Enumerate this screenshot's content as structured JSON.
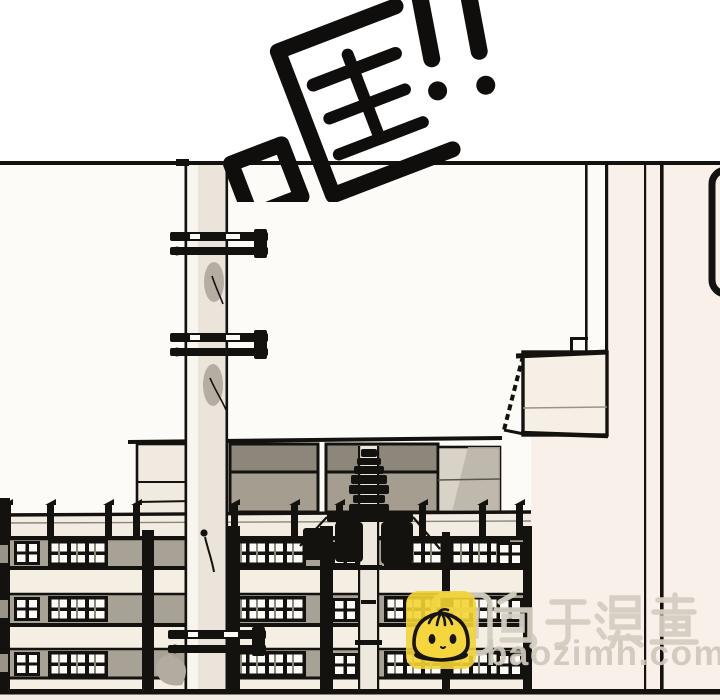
{
  "sfx": {
    "text": "哐!!"
  },
  "watermark": {
    "site_name": "包子漫畫",
    "site_url": "baozimh.com",
    "mascot_icon": "baozi-bun-mascot-icon",
    "text_color": "#d5cfc3",
    "mascot_bg_color": "#f3d434"
  },
  "panel": {
    "type": "comic-panel",
    "colors": {
      "ink": "#14120f",
      "paper_white": "#fcfbf8",
      "wall_cream": "#f9f1e9",
      "building_cream": "#f5eee3",
      "pole_cream": "#ebe4da",
      "roof_gray_dark": "#8d877b",
      "roof_gray_mid": "#a49d90",
      "window_band_gray": "#a8a195",
      "shadow_gray": "#b3aba0"
    }
  }
}
